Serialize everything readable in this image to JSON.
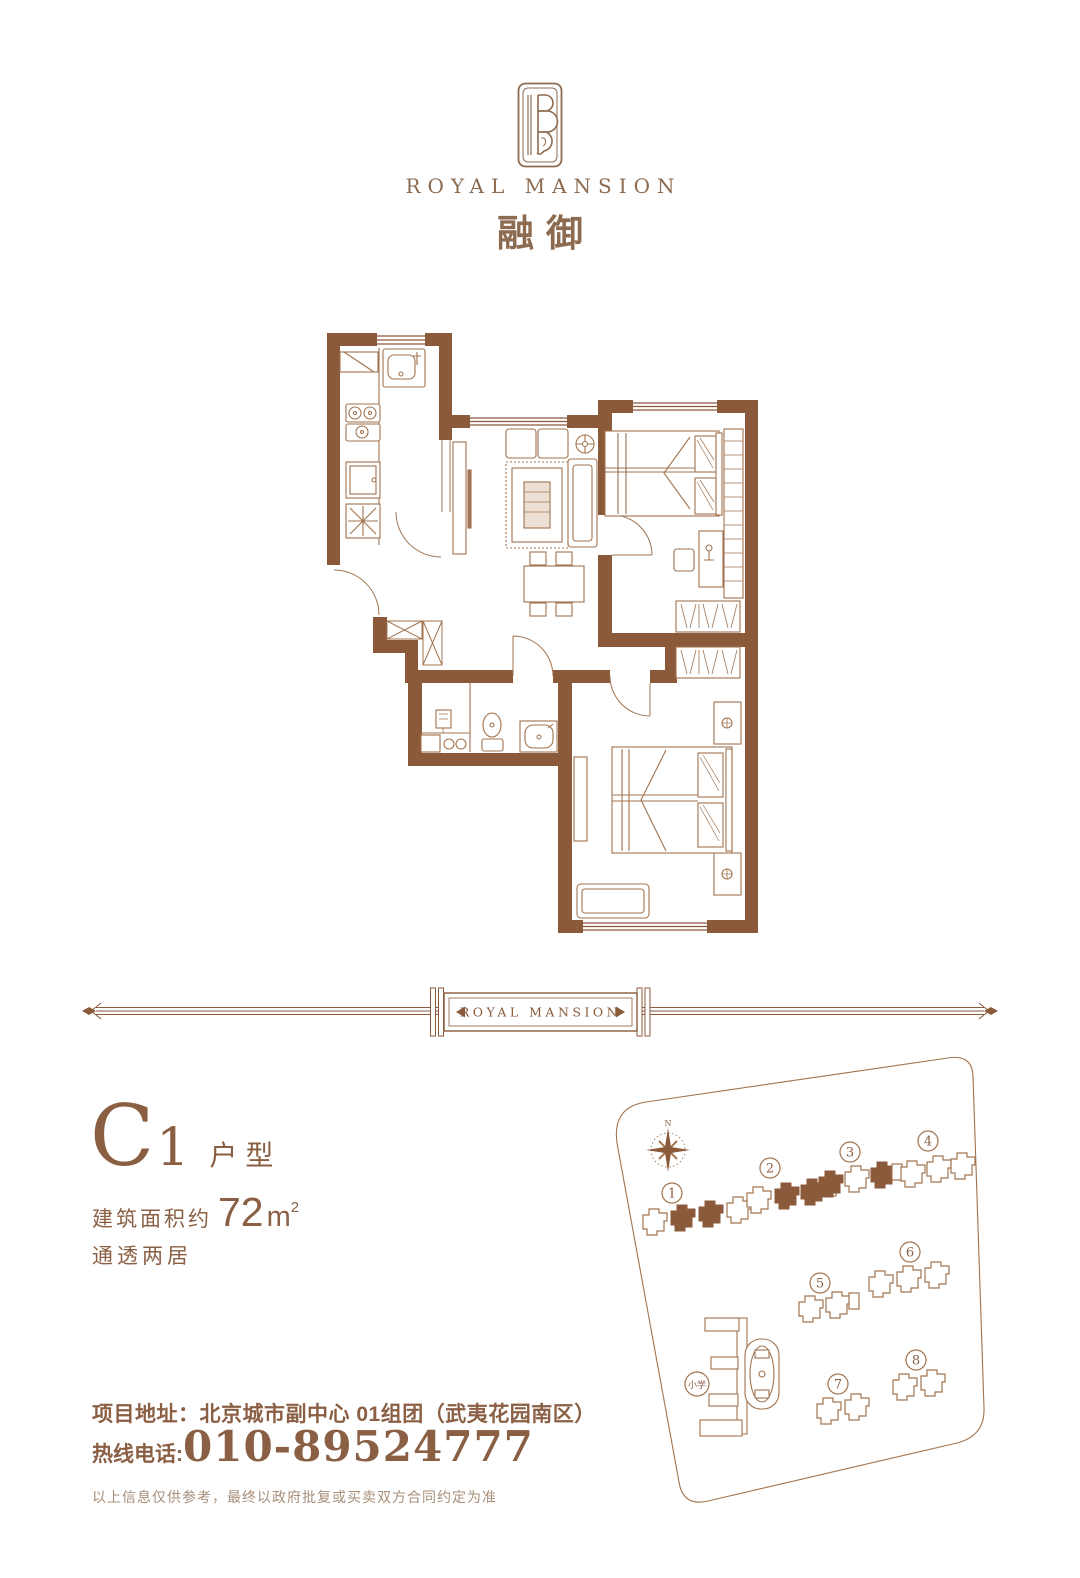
{
  "brand": {
    "logo_en": "ROYAL MANSION",
    "logo_cn": "融御",
    "divider_label": "ROYAL MANSION"
  },
  "unit": {
    "type_letter": "C",
    "type_number": "1",
    "type_label": "户型",
    "area_prefix": "建筑面积约",
    "area_value": "72",
    "area_unit": "m",
    "area_exponent": "2",
    "layout": "通透两居"
  },
  "contact": {
    "address_label": "项目地址：",
    "address": "北京城市副中心 01组团（武夷花园南区）",
    "phone_label": "热线电话:",
    "phone": "010-89524777",
    "disclaimer": "以上信息仅供参考，最终以政府批复或买卖双方合同约定为准"
  },
  "site_map": {
    "north": "N",
    "school": "小学",
    "buildings": [
      "1",
      "2",
      "3",
      "4",
      "5",
      "6",
      "7",
      "8"
    ]
  },
  "colors": {
    "wall": "#8b5a3a",
    "line": "#a1744f",
    "text": "#8a5f44",
    "logo": "#8d6b50"
  }
}
